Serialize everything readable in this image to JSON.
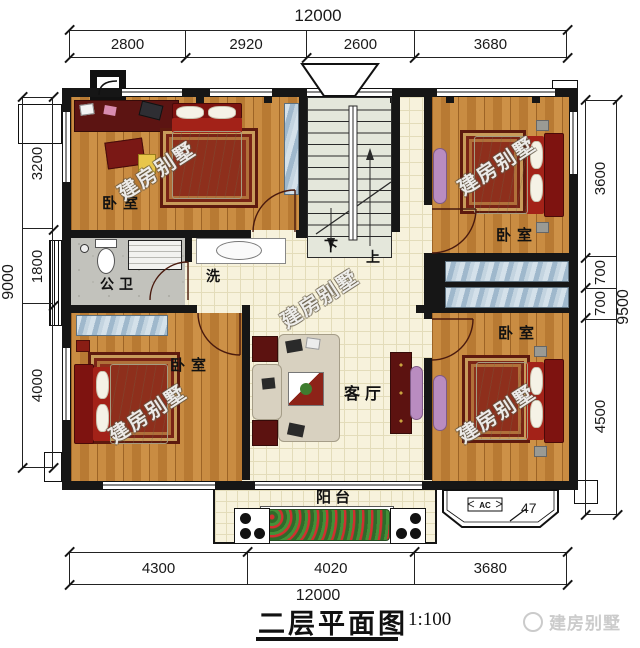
{
  "title": {
    "text": "二层平面图",
    "scale": "1:100"
  },
  "brand": {
    "logo": "建房别墅"
  },
  "watermark": {
    "text": "建房别墅"
  },
  "dimensions": {
    "top": {
      "total": "12000",
      "segments": [
        "2800",
        "2920",
        "2600",
        "3680"
      ]
    },
    "bottom": {
      "total": "12000",
      "segments": [
        "4300",
        "4020",
        "3680"
      ]
    },
    "left": {
      "total": "9000",
      "segments": [
        "3200",
        "1800",
        "4000"
      ]
    },
    "right": {
      "total": "9500",
      "segments": [
        "3600",
        "700",
        "700",
        "4500"
      ]
    },
    "bay_window_offset": "47"
  },
  "rooms": {
    "bedroom_top_left": {
      "label": "卧室"
    },
    "bedroom_top_right": {
      "label": "卧室"
    },
    "bedroom_bottom_left": {
      "label": "卧室"
    },
    "bedroom_bottom_right": {
      "label": "卧室"
    },
    "bathroom": {
      "label": "公卫"
    },
    "wash_area": {
      "label": "洗"
    },
    "living_room": {
      "label": "客厅"
    },
    "balcony": {
      "label": "阳台"
    },
    "stairs": {
      "down": "下",
      "up": "上"
    }
  },
  "annotations": {
    "ac_label": "AC"
  },
  "colors": {
    "wall": "#161616",
    "wood_floor": "#c4873d",
    "tile_floor": "#f7f2dc",
    "bathroom_floor": "#c2c2bc",
    "stair_floor": "#e4e7db",
    "bed_red": "#7e1310",
    "wardrobe_blue": "#b7cbdb",
    "dresser_purple": "#b98cc0",
    "watermark_gray": "#cbcbcb"
  }
}
